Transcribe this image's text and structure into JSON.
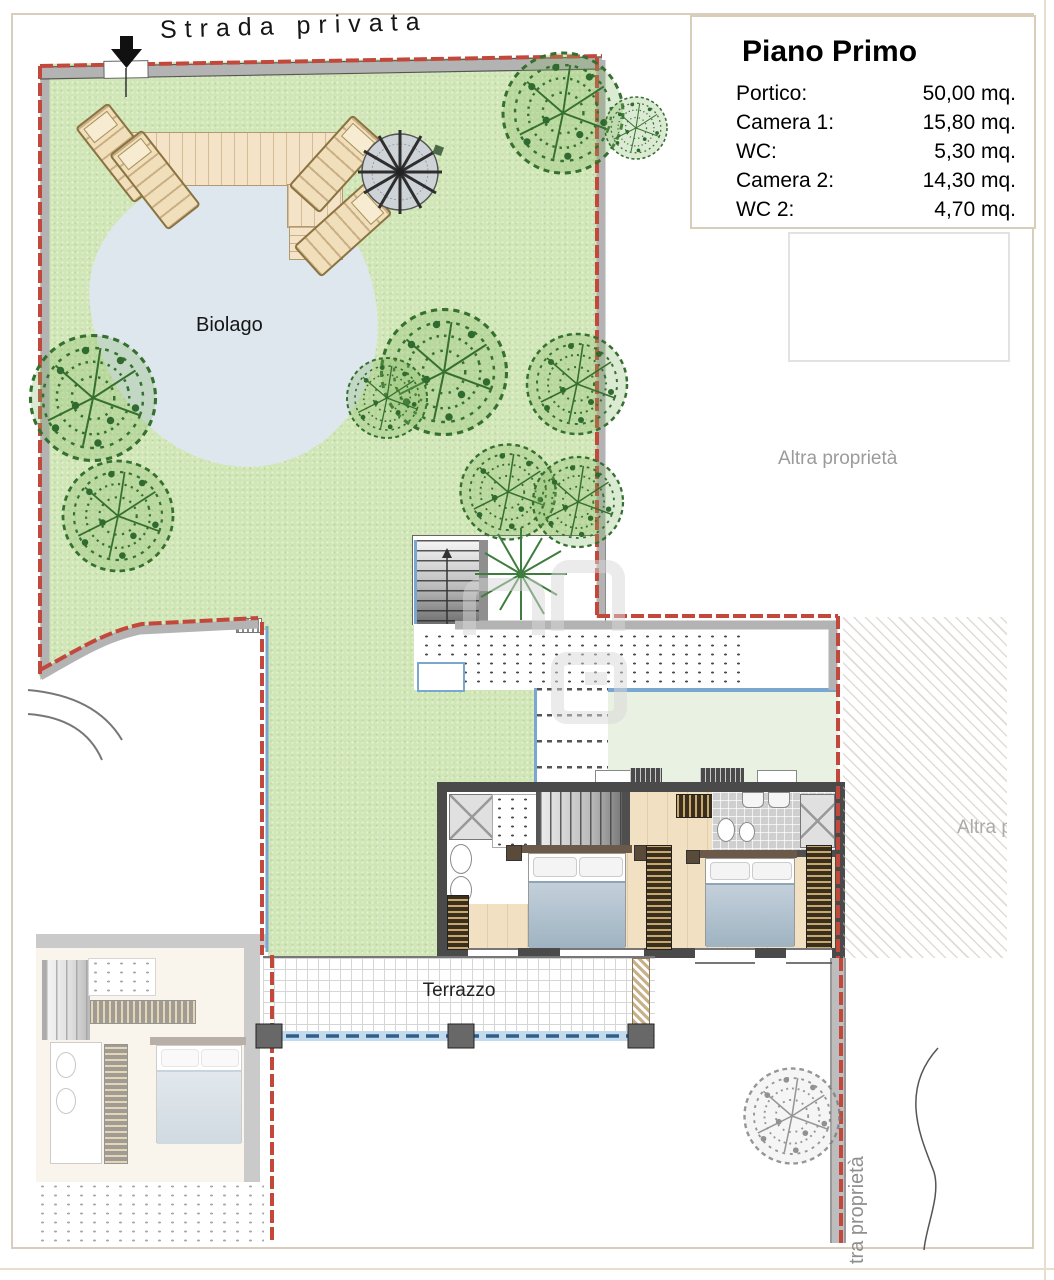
{
  "legend": {
    "title": "Piano Primo",
    "rows": [
      {
        "label": "Portico:",
        "value": "50,00 mq."
      },
      {
        "label": "Camera 1:",
        "value": "15,80 mq."
      },
      {
        "label": "WC:",
        "value": "5,30 mq."
      },
      {
        "label": "Camera 2:",
        "value": "14,30 mq."
      },
      {
        "label": "WC 2:",
        "value": "4,70 mq."
      }
    ]
  },
  "labels": {
    "street": "Strada privata",
    "pond": "Biolago",
    "terrace": "Terrazzo",
    "other_property": "Altra proprietà",
    "other_property_clipped": "Altra proprietà",
    "other_property_vertical": "tra proprietà"
  },
  "colors": {
    "boundary_red": "#c2483c",
    "glass_blue": "#7aa7cf",
    "garden_green": "#d0e6b6",
    "pond_blue": "#dde7ed",
    "deck_wood": "#f4e3c6",
    "building_wall": "#4a4a4a",
    "wood_floor": "#f1e0c2",
    "other_property_text": "#9b9b9b"
  }
}
